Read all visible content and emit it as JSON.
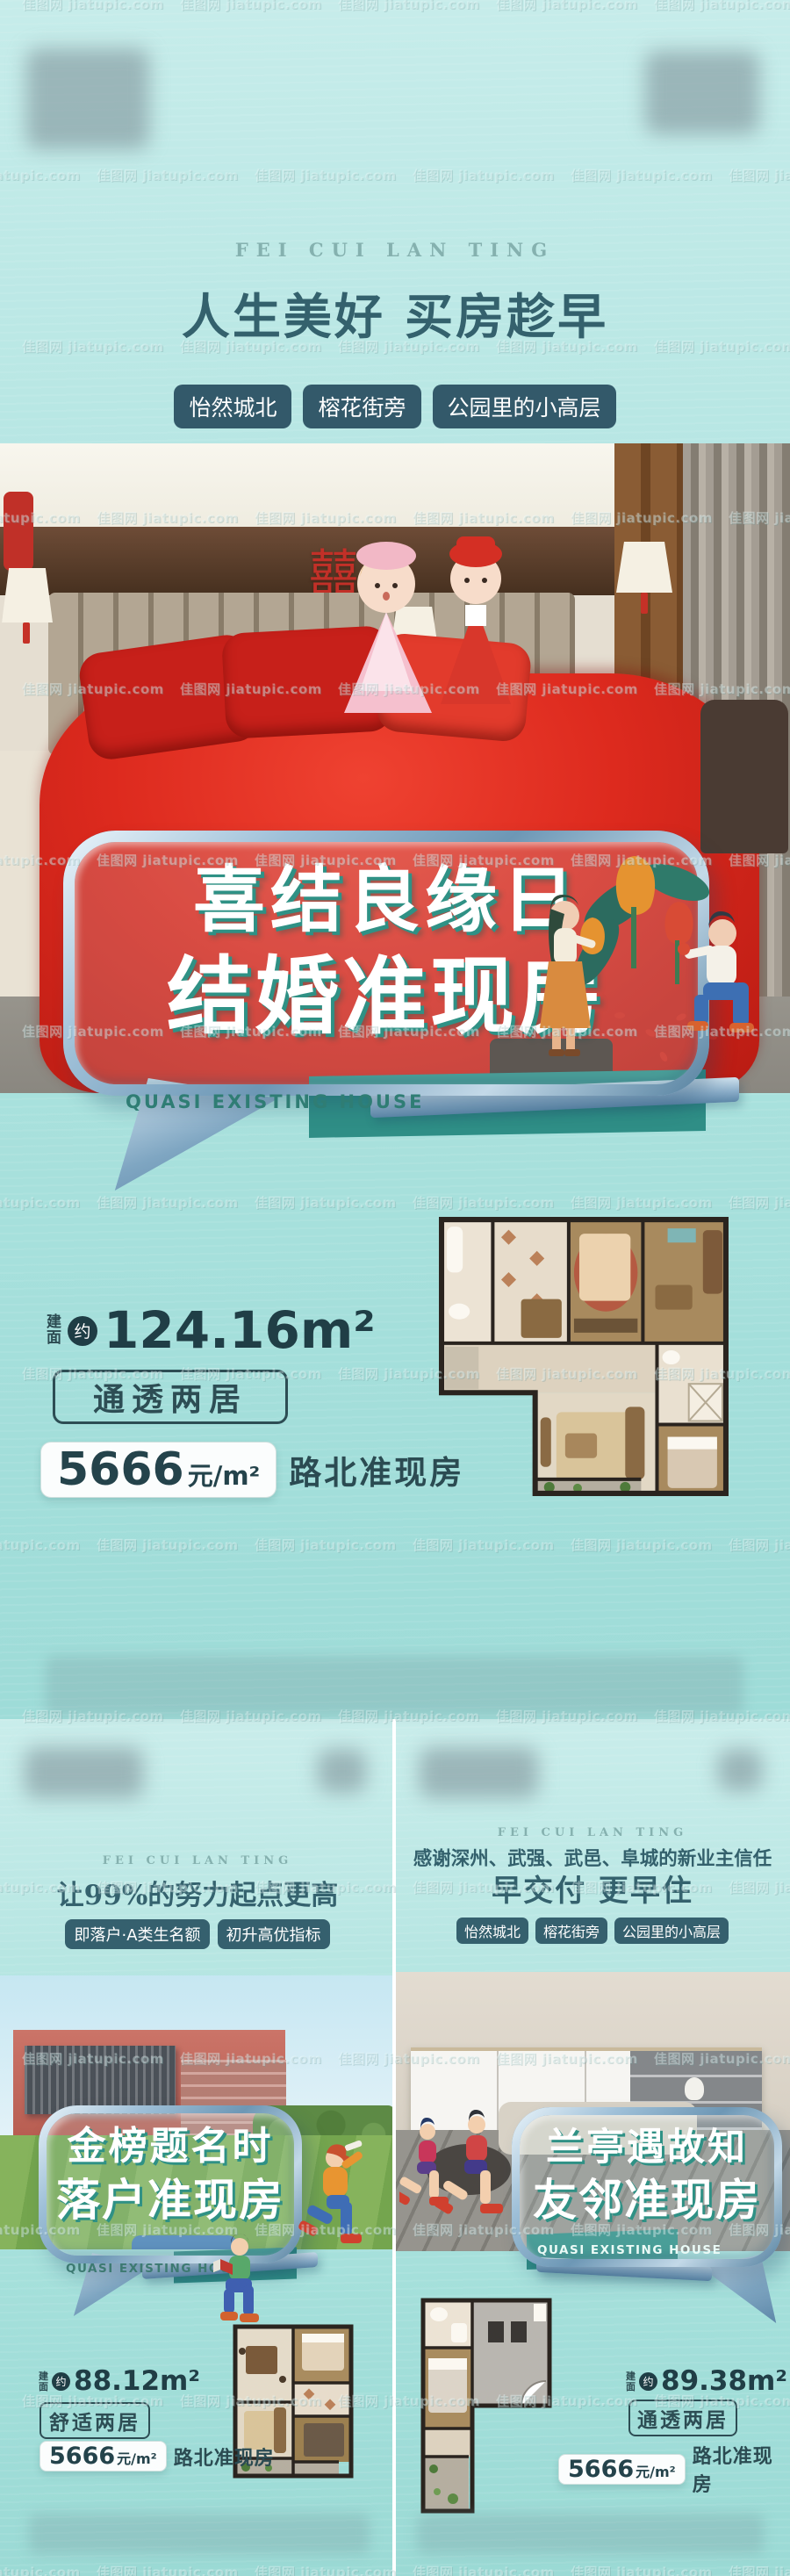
{
  "watermark": {
    "text": "佳图网 jiatupic.com"
  },
  "posters": {
    "main": {
      "brand": "FEI CUI LAN TING",
      "title": "人生美好 买房趁早",
      "tags": [
        "怡然城北",
        "榕花街旁",
        "公园里的小高层"
      ],
      "bubble_line1": "喜结良缘日",
      "bubble_line2": "结婚准现房",
      "bubble_caption": "QUASI EXISTING HOUSE",
      "decor_double_happiness": "囍",
      "area_label_char1": "建",
      "area_label_char2": "面",
      "area_approx": "约",
      "area_value": "124.16m²",
      "layout_tag": "通透两居",
      "price_value": "5666",
      "price_unit": "元/m²",
      "price_note": "路北准现房"
    },
    "left": {
      "brand": "FEI CUI LAN TING",
      "title": "让99%的努力起点更高",
      "tags": [
        "即落户·A类生名额",
        "初升高优指标"
      ],
      "bubble_line1": "金榜题名时",
      "bubble_line2": "落户准现房",
      "bubble_caption": "QUASI EXISTING HOUSE",
      "area_label_char1": "建",
      "area_label_char2": "面",
      "area_approx": "约",
      "area_value": "88.12m²",
      "layout_tag": "舒适两居",
      "price_value": "5666",
      "price_unit": "元/m²",
      "price_note": "路北准现房"
    },
    "right": {
      "brand": "FEI CUI LAN TING",
      "subtitle": "感谢深州、武强、武邑、阜城的新业主信任",
      "title": "早交付 更早住",
      "tags": [
        "怡然城北",
        "榕花街旁",
        "公园里的小高层"
      ],
      "bubble_line1": "兰亭遇故知",
      "bubble_line2": "友邻准现房",
      "bubble_caption": "QUASI EXISTING HOUSE",
      "area_label_char1": "建",
      "area_label_char2": "面",
      "area_approx": "约",
      "area_value": "89.38m²",
      "layout_tag": "通透两居",
      "price_value": "5666",
      "price_unit": "元/m²",
      "price_note": "路北准现房"
    }
  },
  "colors": {
    "background_aqua": "#aee3e0",
    "deep_teal_pill": "#33596a",
    "title_teal": "#34616d",
    "bubble_extrude_teal": "#2f9185",
    "teal_band": "#2f8e86",
    "price_text": "#24434b",
    "bubble_frame_steel": "#87aac6"
  }
}
